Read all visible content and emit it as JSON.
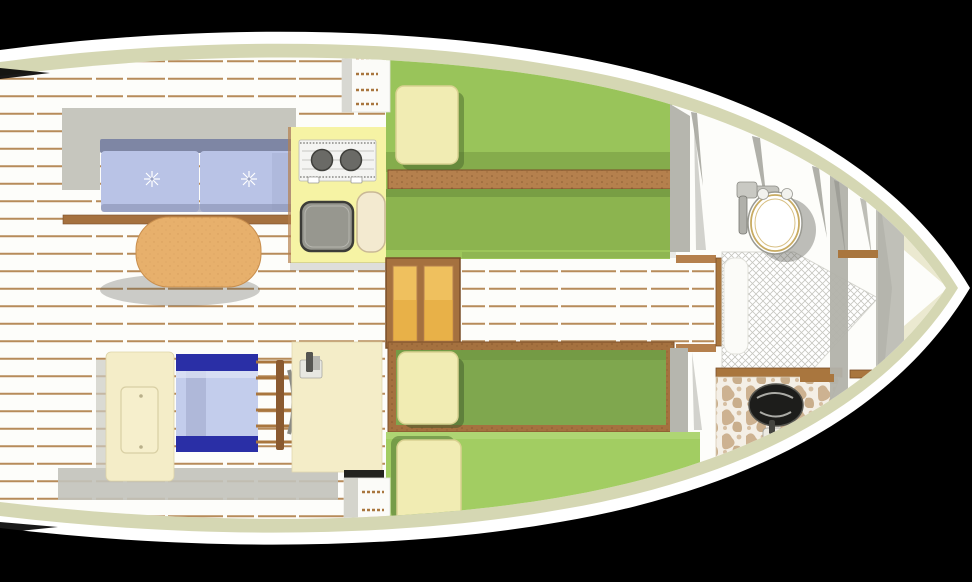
{
  "scene": {
    "title": "sailboat-interior-floor-plan-top-view",
    "background_color": "#000000"
  },
  "colors": {
    "background": "#000000",
    "hull_white": "#ffffff",
    "hull_band": "#d5d7b3",
    "floor_white": "#fdfdfa",
    "plank_seam": "#aa763e",
    "platform_gray": "#c6c6be",
    "shadow_gray": "#c2c2ba",
    "settee_rail": "#7e86a4",
    "settee_cushion": "#b9c3e6",
    "wood_trim": "#a5713f",
    "wood_plank": "#b5804d",
    "table_wood": "#e7b06c",
    "galley_counter": "#f6f3a4",
    "stove_body": "#f4f4f2",
    "burner": "#6a6a66",
    "sink_basin": "#97978f",
    "cutting_board": "#f3ead0",
    "berth_green": "#99c45a",
    "berth_green_seat": "#8cb44f",
    "berth_green_dark": "#7fa74e",
    "berth_green_light": "#a2cd62",
    "pillow": "#f1ecb3",
    "steps_frame": "#a5713f",
    "steps_tread": "#efc05e",
    "bunk_blue": "#c3cdec",
    "bunk_navy": "#2a2fa6",
    "cabinet_cream": "#f4edc8",
    "bulkhead_gray": "#b6b6ae",
    "toilet_white": "#ffffff",
    "toilet_ring_gold": "#c8ab62",
    "vanity_tan": "#cdb291",
    "basin_black": "#1d1d1b",
    "ladder_wood": "#8a5a30"
  },
  "areas": [
    {
      "name": "saloon",
      "items": [
        "settee",
        "dining-table",
        "plank-floor"
      ]
    },
    {
      "name": "galley",
      "items": [
        "two-burner-stove",
        "galley-sink",
        "cutting-board",
        "counter"
      ]
    },
    {
      "name": "port-berth",
      "items": [
        "mattress",
        "pillow",
        "shelf-rail"
      ]
    },
    {
      "name": "companionway",
      "items": [
        "steps-box",
        "wood-ladder",
        "side-steps"
      ]
    },
    {
      "name": "starboard-berths",
      "items": [
        "quarter-berth",
        "settee-berth",
        "pillows"
      ]
    },
    {
      "name": "aft-cabin",
      "items": [
        "blue-bunk",
        "locker-hatch",
        "chart-table"
      ]
    },
    {
      "name": "head",
      "items": [
        "marine-toilet",
        "shower-floor",
        "vanity-basin"
      ]
    },
    {
      "name": "bow-locker",
      "items": [
        "forward-bulkhead"
      ]
    }
  ]
}
